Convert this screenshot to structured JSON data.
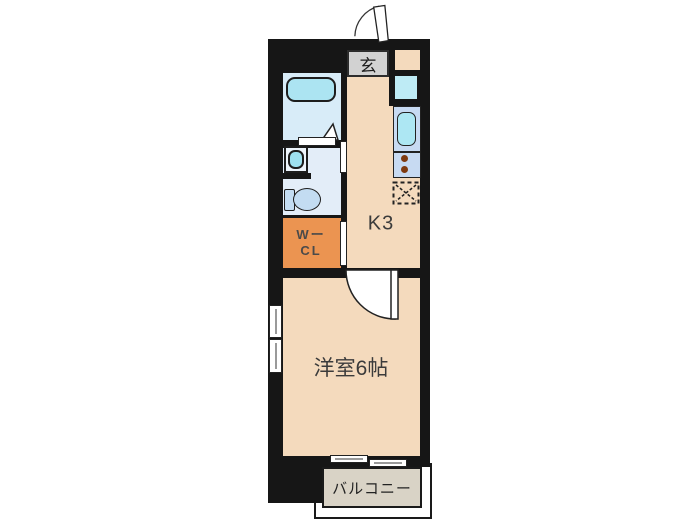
{
  "floorplan": {
    "type": "apartment-floor-plan",
    "rooms": {
      "entrance": {
        "label": "玄"
      },
      "kitchen": {
        "label": "K3"
      },
      "walk_in_closet": {
        "label_line1": "Wー",
        "label_line2": "CL"
      },
      "western_room": {
        "label": "洋室6帖"
      },
      "balcony": {
        "label": "バルコニー"
      }
    },
    "fixtures": [
      "entrance-door-swing",
      "bathtub",
      "bathroom-folding-door",
      "wash-basin",
      "toilet",
      "washing-machine-space",
      "kitchen-sink",
      "stove-burners",
      "refrigerator-space",
      "room-door-swing",
      "sliding-window-left",
      "sliding-window-balcony"
    ],
    "colors": {
      "wall": "#161616",
      "floor_beige": "#f4dabd",
      "bathroom_floor": "#d8ecf8",
      "washroom_floor": "#e3edf8",
      "bathtub": "#ace4f2",
      "toilet": "#c3dcf2",
      "kitchen_counter": "#c7daf2",
      "kitchen_sink": "#ade7f3",
      "washer_space": "#beebf5",
      "closet_orange": "#eb9451",
      "entrance_gray": "#d2d2d2",
      "balcony_taupe": "#d9d3c6",
      "burner_dot": "#7f3a10",
      "background": "#ffffff"
    }
  }
}
